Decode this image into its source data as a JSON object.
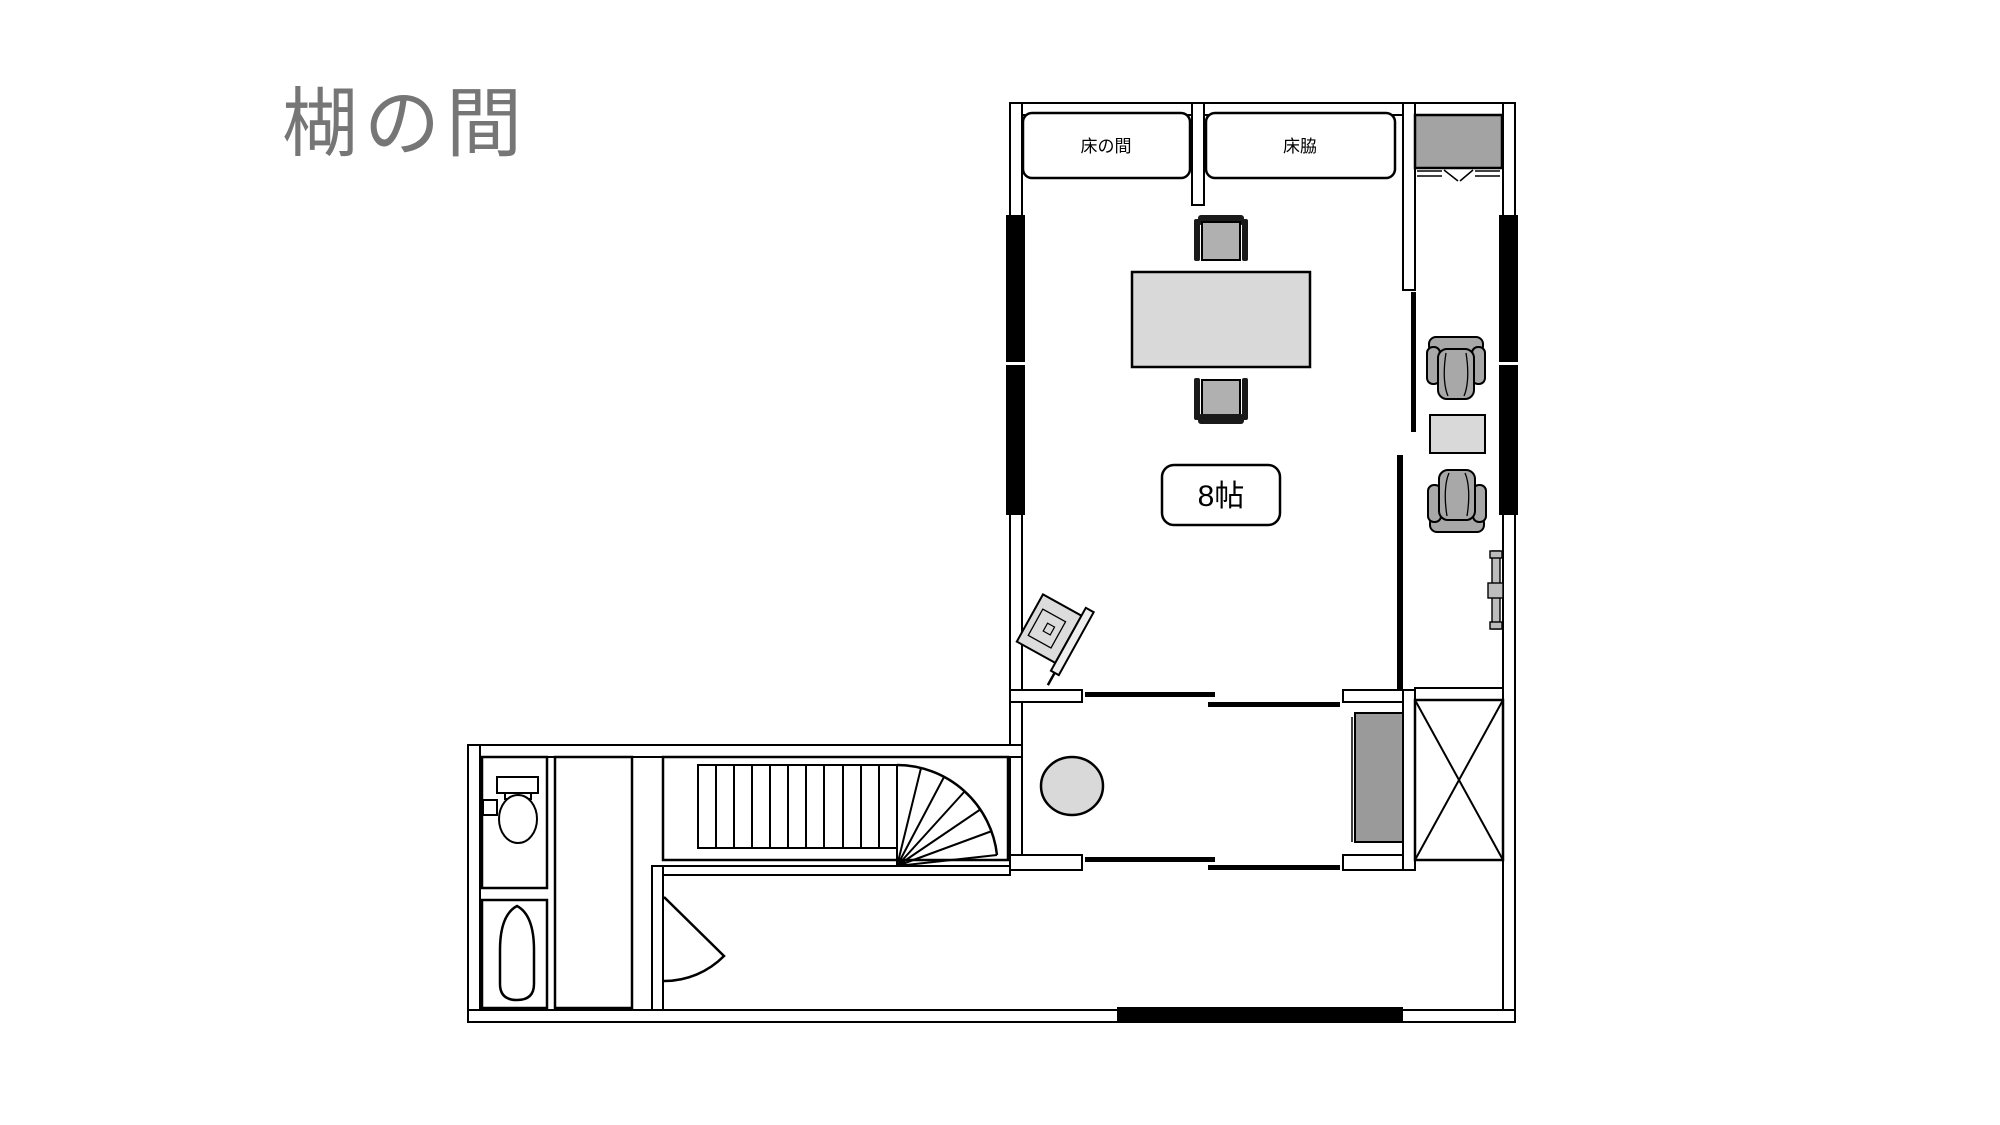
{
  "page": {
    "background_color": "#ffffff"
  },
  "title": {
    "text": "楜の間",
    "color": "#767676"
  },
  "floor_plan": {
    "labels": {
      "tokonoma": "床の間",
      "tokowaki": "床脇",
      "main_room_size": "8帖"
    },
    "colors": {
      "wall_line": "#000000",
      "light_furniture_fill": "#d9d9d9",
      "chair_fill": "#a8a8a8",
      "closet_fill": "#a3a3a3",
      "chest_fill": "#9a9a9a"
    },
    "symbols": [
      "tokonoma-alcove",
      "tokowaki-alcove",
      "bifold-closet",
      "window-band",
      "sliding-door",
      "floor-chair",
      "low-table",
      "tatami-size-badge",
      "tv-on-stand",
      "armchair",
      "side-table",
      "window-handle",
      "entry-stool",
      "chest",
      "storage-x-box",
      "straight-stairs",
      "winder-stairs",
      "swing-door",
      "toilet",
      "urinal"
    ]
  }
}
